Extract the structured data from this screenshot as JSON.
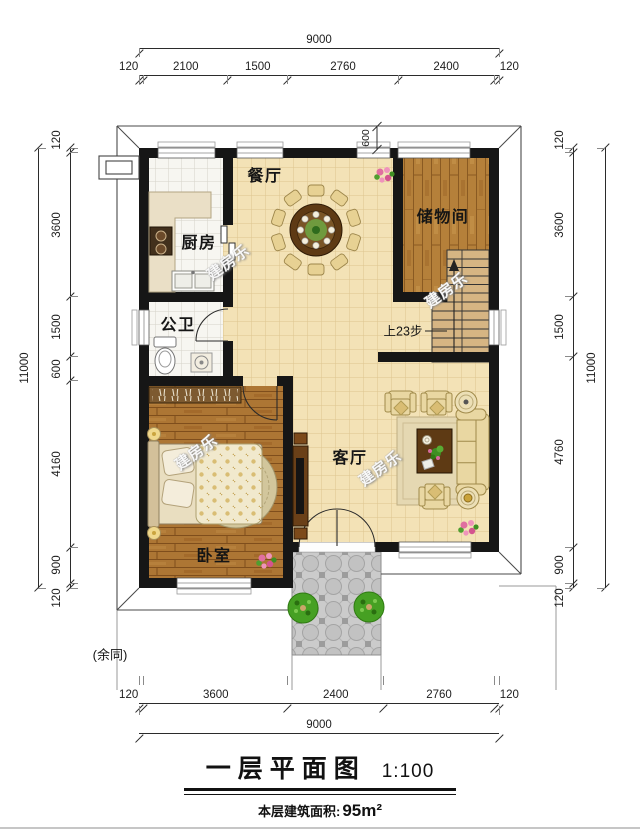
{
  "title": {
    "name": "一层平面图",
    "scale": "1:100",
    "area_label": "本层建筑面积:",
    "area_value": "95m²"
  },
  "watermark": "建房乐",
  "rooms": {
    "dining": {
      "label": "餐厅"
    },
    "kitchen": {
      "label": "厨房"
    },
    "storage": {
      "label": "储物间"
    },
    "bathroom": {
      "label": "公卫"
    },
    "living": {
      "label": "客厅"
    },
    "bedroom": {
      "label": "卧室"
    }
  },
  "annotations": {
    "stairs_note": "上23步",
    "same_note": "(余同)",
    "eave_dim": "600"
  },
  "dimensions": {
    "top": {
      "total": [
        9000
      ],
      "segments": [
        120,
        2100,
        1500,
        2760,
        2400,
        120
      ]
    },
    "bottom": {
      "total": [
        9000
      ],
      "segments": [
        120,
        3600,
        2400,
        2760,
        120
      ]
    },
    "left": {
      "total": [
        11000
      ],
      "segments": [
        120,
        3600,
        1500,
        600,
        4160,
        900,
        120
      ]
    },
    "right": {
      "total": [
        11000
      ],
      "segments": [
        120,
        3600,
        1500,
        4760,
        900,
        120
      ]
    }
  },
  "colors": {
    "wall": "#161616",
    "tile": "#f3e2b6",
    "tile-line": "#dcc48f",
    "ktile": "#f7f6f1",
    "ktile-line": "#d6d3c9",
    "wood": "#b5803a",
    "wood-line": "#8a5a22",
    "woodh": "#ad7634",
    "woodh-line": "#7f4e1c",
    "porch": "#cbcbcb",
    "counter": "#eadfc6",
    "sofa": "#e9d7a2",
    "darkwood": "#5e3a14",
    "rug": "#d2c69c",
    "stair": "#d6b583",
    "plant": "#46a023",
    "flower": "#e06fa0"
  }
}
